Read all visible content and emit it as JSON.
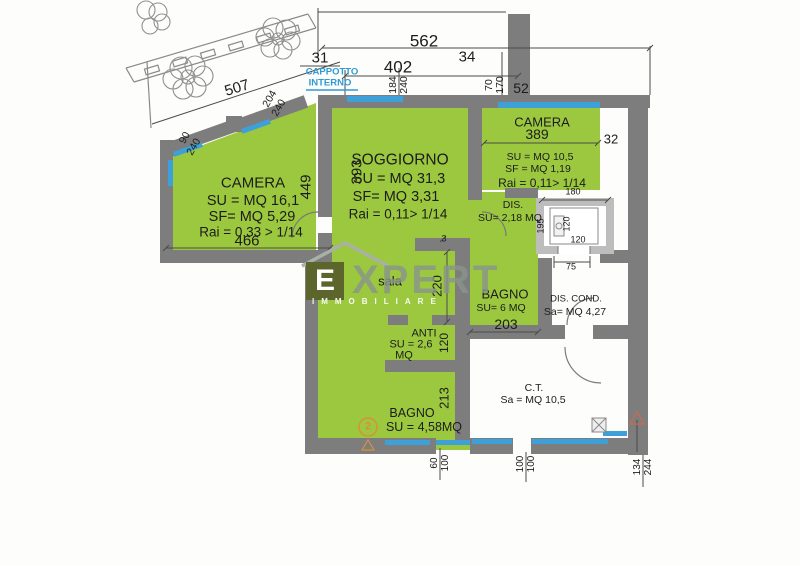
{
  "colors": {
    "room_green": "#9cc83f",
    "wall_gray": "#7d7d7d",
    "window_blue": "#3da0d8",
    "note_blue": "#2e9bd6",
    "accent_orange": "#d98f3e",
    "logo_square": "#5c662c"
  },
  "top_dims": {
    "total": "562",
    "left": "31",
    "mid": "402",
    "small": "34",
    "diag": "507",
    "col": "52"
  },
  "window_dims": {
    "w184": "184",
    "w240a": "240",
    "w70": "70",
    "w170": "170",
    "w204": "204",
    "w240b": "240",
    "w90": "90",
    "w240c": "240"
  },
  "note": {
    "line1": "CAPPOTTO",
    "line2": "INTERNO"
  },
  "camera1": {
    "name": "CAMERA",
    "su": "SU = MQ 16,1",
    "sf": "SF= MQ  5,29",
    "rai": "Rai = 0,33 > 1/14",
    "width": "466",
    "height": "449"
  },
  "soggiorno": {
    "name": "SOGGIORNO",
    "su": "SU = MQ 31,3",
    "sf": "SF= MQ  3,31",
    "rai": "Rai = 0,11> 1/14",
    "height": "393"
  },
  "camera2": {
    "name": "CAMERA",
    "width": "389",
    "wall": "32",
    "su": "SU = MQ 10,5",
    "sf": "SF = MQ 1,19",
    "rai": "Rai = 0,11> 1/14"
  },
  "dis": {
    "name": "DIS.",
    "su": "SU= 2,18 MQ"
  },
  "lift": {
    "top": "180",
    "left": "195",
    "inner_v": "120",
    "inner_h": "120",
    "door": "75"
  },
  "sala": {
    "name": "sala",
    "height": "220",
    "tick": "3"
  },
  "bagno1": {
    "name": "BAGNO",
    "su": "SU= 6 MQ",
    "width": "203"
  },
  "dis_cond": {
    "name": "DIS. COND.",
    "sa": "Sa= MQ 4,27"
  },
  "anti": {
    "name": "ANTI",
    "su": "SU = 2,6",
    "su2": "MQ",
    "height": "120"
  },
  "bagno2": {
    "name": "BAGNO",
    "su": "SU = 4,58MQ",
    "height": "213"
  },
  "ct": {
    "name": "C.T.",
    "sa": "Sa = MQ 10,5"
  },
  "bottom_dims": {
    "a1": "60",
    "a2": "100",
    "b1": "100",
    "b2": "100",
    "c1": "134",
    "c2": "244"
  },
  "badge": {
    "number": "2"
  },
  "watermark": {
    "initial": "E",
    "rest": "XPERT",
    "sub": "IMMOBILIARE"
  }
}
